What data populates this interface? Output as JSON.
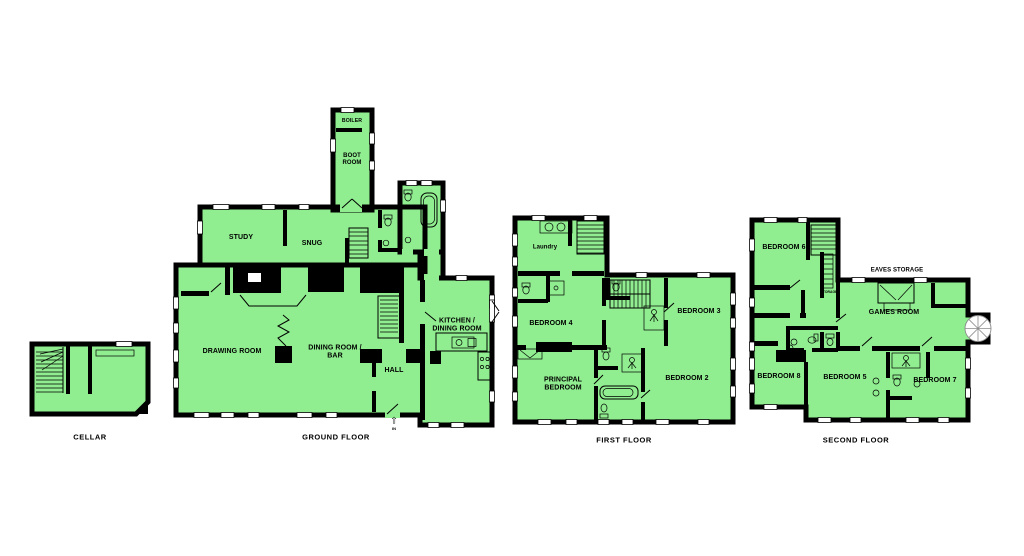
{
  "colors": {
    "room_fill": "#90ee90",
    "wall": "#000000",
    "spiral_stroke": "#8a8a8a"
  },
  "floors": {
    "cellar": {
      "title": "CELLAR"
    },
    "ground": {
      "title": "GROUND FLOOR",
      "rooms": {
        "boiler": "BOILER",
        "boot_room": "BOOT\nROOM",
        "study": "STUDY",
        "snug": "SNUG",
        "drawing_room": "DRAWING ROOM",
        "dining_room_bar": "DINING ROOM /\nBAR",
        "hall": "HALL",
        "kitchen_dining": "KITCHEN /\nDINING ROOM"
      },
      "entrance": {
        "arrow": "⇧",
        "label": "IN"
      }
    },
    "first": {
      "title": "FIRST FLOOR",
      "rooms": {
        "laundry": "Laundry",
        "bedroom4": "BEDROOM 4",
        "bedroom3": "BEDROOM 3",
        "bedroom2": "BEDROOM 2",
        "principal_bedroom": "PRINCIPAL\nBEDROOM"
      }
    },
    "second": {
      "title": "SECOND FLOOR",
      "rooms": {
        "bedroom6": "BEDROOM 6",
        "storage": "STORAGE",
        "eaves_storage": "EAVES STORAGE",
        "games_room": "GAMES ROOM",
        "bedroom8": "BEDROOM 8",
        "bedroom5": "BEDROOM 5",
        "bedroom7": "BEDROOM 7"
      }
    }
  }
}
